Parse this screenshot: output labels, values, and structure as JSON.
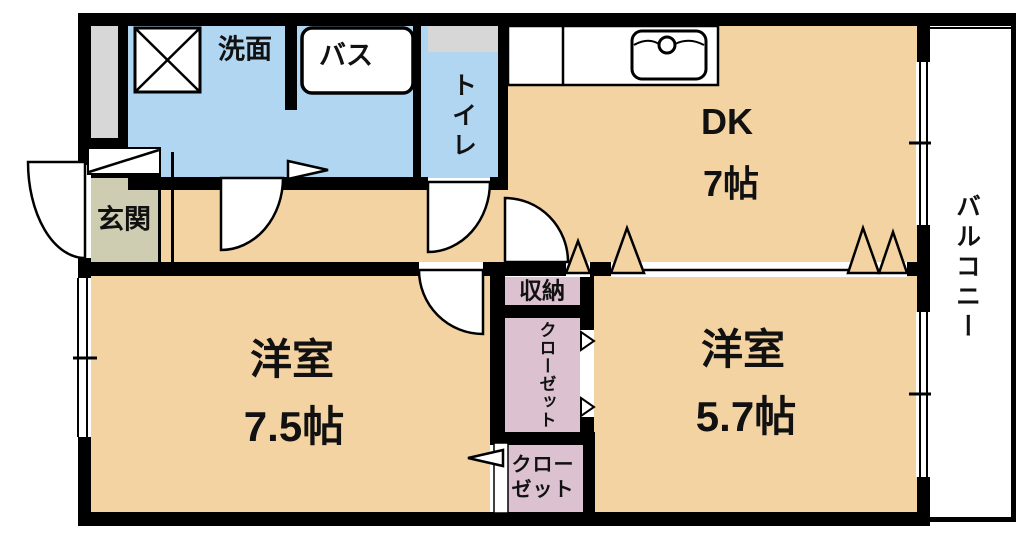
{
  "floorplan": {
    "rooms": {
      "washroom": {
        "label": "洗面"
      },
      "bath": {
        "label": "バス"
      },
      "toilet": {
        "label": "トイレ"
      },
      "dining_kitchen": {
        "label": "DK",
        "size": "7帖"
      },
      "entrance": {
        "label": "玄関"
      },
      "western_room_1": {
        "label": "洋室",
        "size": "7.5帖"
      },
      "western_room_2": {
        "label": "洋室",
        "size": "5.7帖"
      },
      "storage": {
        "label": "収納"
      },
      "closet_middle": {
        "label": "クローゼット"
      },
      "closet_bottom": {
        "line1": "クロー",
        "line2": "ゼット"
      },
      "balcony": {
        "label": "バルコニー"
      }
    },
    "colors": {
      "wall": "#000000",
      "floor_beige": "#f4d3a2",
      "wet_area_blue": "#b0d6f2",
      "closet_pink": "#dcc2d0",
      "entrance_olive": "#cecdb1",
      "fixture_gray": "#d7d7d7",
      "text": "#111111"
    }
  }
}
